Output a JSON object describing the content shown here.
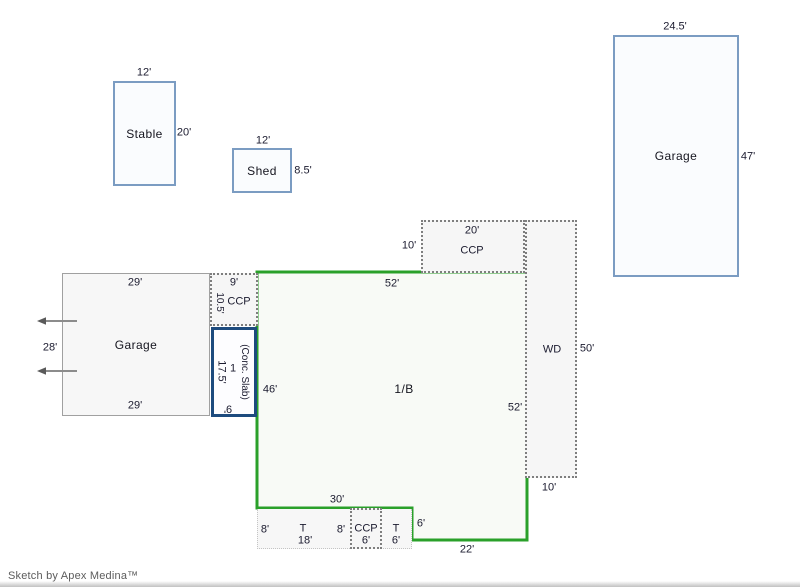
{
  "credit": "Sketch by Apex Medina™",
  "colors": {
    "house_outline": "#2aa02a",
    "outbuilding_border": "#7b9cc2",
    "slab_border": "#1d4b7e",
    "dashed_border": "#7e7e7e"
  },
  "stable": {
    "name": "Stable",
    "width": "12'",
    "height": "20'"
  },
  "shed": {
    "name": "Shed",
    "width": "12'",
    "height": "8.5'"
  },
  "garage_ne": {
    "name": "Garage",
    "width": "24.5'",
    "height": "47'"
  },
  "garage_left": {
    "name": "Garage",
    "top": "29'",
    "bottom": "29'",
    "side": "28'"
  },
  "ccp_upper_left": {
    "name": "CCP",
    "top": "9'",
    "side": "10.5'"
  },
  "conc_slab": {
    "side": "17.5'",
    "story": "1",
    "name": "(Conc. Slab)",
    "bottom": "9'"
  },
  "house": {
    "name": "1/B",
    "top": "52'",
    "left": "46'",
    "right": "52'",
    "bottom_left": "30'",
    "step": "6'",
    "bottom_right": "22'"
  },
  "ccp_top": {
    "name": "CCP",
    "top": "20'",
    "side": "10'"
  },
  "wd": {
    "name": "WD",
    "side": "50'",
    "bottom": "10'"
  },
  "porch": {
    "left_depth": "8'",
    "t1": "T",
    "t1_dim": "18'",
    "right_depth": "8'",
    "ccp": "CCP",
    "ccp_dim": "6'",
    "t2": "T",
    "t2_dim": "6'"
  }
}
